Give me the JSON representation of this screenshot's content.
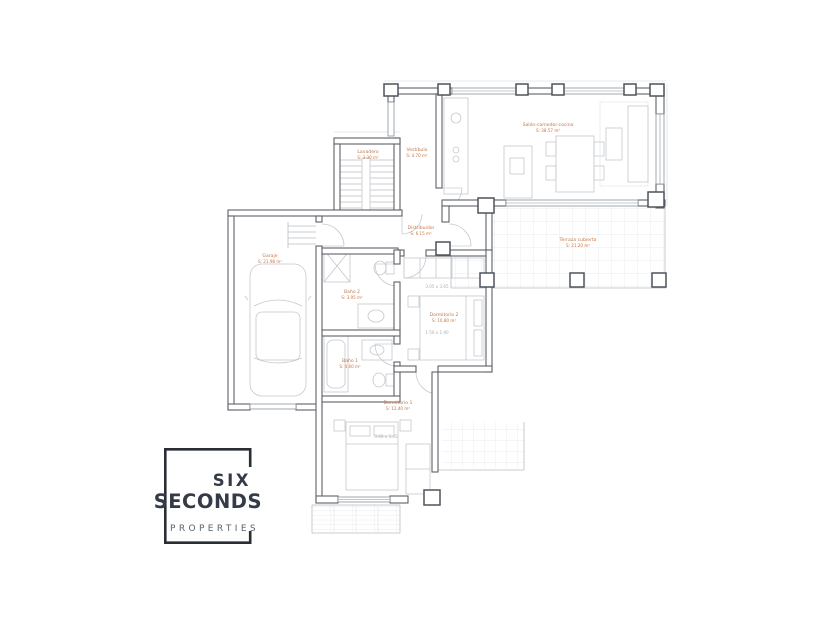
{
  "plan": {
    "label_color": "#c67848",
    "wall_color": "#5c6269",
    "furniture_color": "#c3c8cd",
    "tile_color": "#e2e5e8",
    "rooms": [
      {
        "name": "Lavadero",
        "area": "S: 3.30 m²"
      },
      {
        "name": "Vestíbulo",
        "area": "S: 4.70 m²"
      },
      {
        "name": "Salón-comedor-cocina",
        "area": "S: 38.57 m²"
      },
      {
        "name": "Distribuidor",
        "area": "S: 6.15 m²"
      },
      {
        "name": "Terraza cubierta",
        "area": "S: 21.20 m²"
      },
      {
        "name": "Garaje",
        "area": "S: 21.98 m²"
      },
      {
        "name": "Baño 2",
        "area": "S: 3.95 m²"
      },
      {
        "name": "Dormitorio 2",
        "area": "S: 10.80 m²"
      },
      {
        "name": "Baño 1",
        "area": "S: 4.60 m²"
      },
      {
        "name": "Dormitorio 1",
        "area": "S: 12.40 m²"
      }
    ],
    "dims": [
      "3.05 x 3.65",
      "1.50 x 1.90",
      "3.60 x 3.45"
    ]
  },
  "logo": {
    "brand_top": "SIX",
    "brand_bottom": "SECONDS",
    "tagline": "PROPERTIES",
    "color": "#282d36"
  }
}
